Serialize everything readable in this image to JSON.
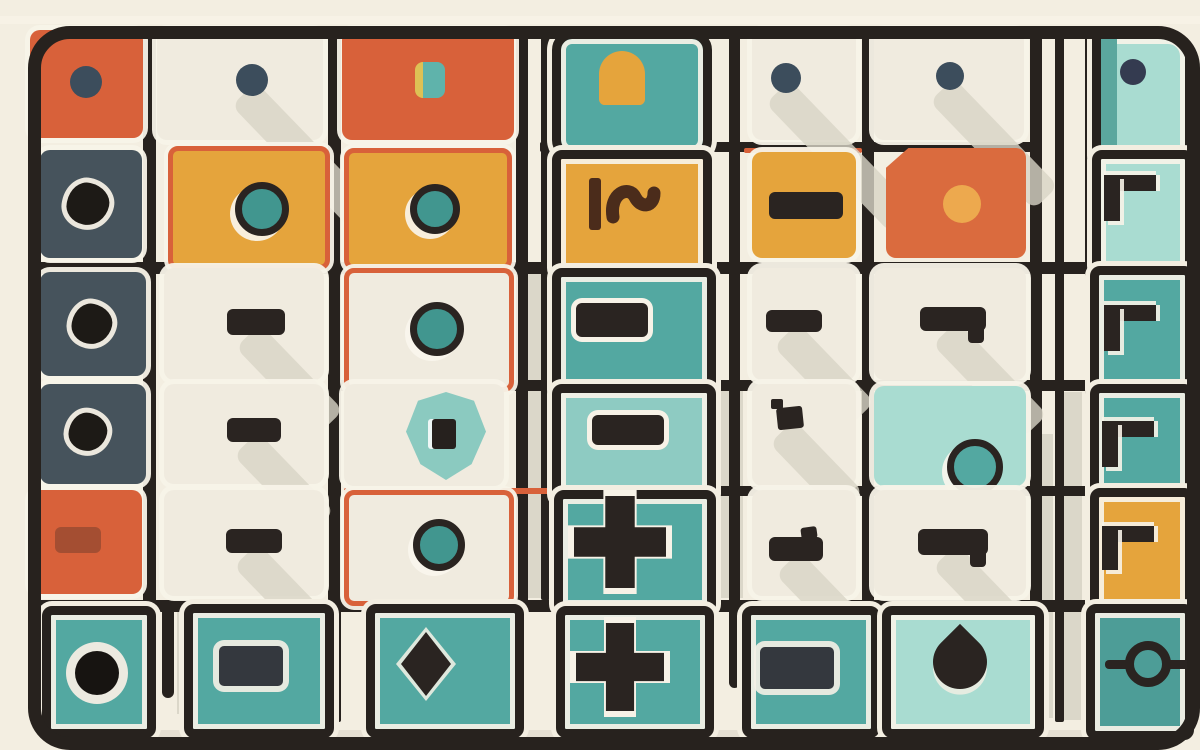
{
  "scene": {
    "title": "abstract-tile-grid-illustration",
    "palette": {
      "bg": "#f3eee1",
      "line": "#27221e",
      "cream": "#f0ebdf",
      "cream_bright": "#f7f2e7",
      "orange": "#d8613a",
      "orange_deep": "#da6b3e",
      "amber": "#e5a43c",
      "teal": "#53a8a1",
      "teal_deep": "#4d9d97",
      "teal_mid": "#8ecbc2",
      "teal_light": "#a9dcd1",
      "slate": "#46535c",
      "dark": "#2a2421",
      "navy": "#3c4d5c",
      "navy_deep": "#343b50",
      "gray": "#d8d4c6",
      "ring_teal": "#41968f",
      "amber_dot": "#eda94e",
      "brown": "#4b2c1b",
      "yellow_sliver": "#ddc155"
    },
    "decor": [
      {
        "x": 520,
        "y": 270,
        "w": 30,
        "h": 328,
        "color": "gray",
        "opacity": 0.9
      },
      {
        "x": 703,
        "y": 388,
        "w": 40,
        "h": 210,
        "color": "gray",
        "opacity": 0.9
      },
      {
        "x": 745,
        "y": 606,
        "w": 38,
        "h": 112,
        "color": "gray",
        "opacity": 0.9
      },
      {
        "x": 1060,
        "y": 392,
        "w": 22,
        "h": 328,
        "color": "gray",
        "opacity": 0.9
      },
      {
        "x": 1033,
        "y": 434,
        "w": 20,
        "h": 284,
        "color": "gray",
        "opacity": 0.9
      },
      {
        "x": 177,
        "y": 602,
        "w": 18,
        "h": 112,
        "color": "gray",
        "opacity": 0.9
      },
      {
        "x": 90,
        "y": 730,
        "w": 1020,
        "h": 12,
        "color": "gray",
        "opacity": 0.55,
        "round": true
      },
      {
        "x": 0,
        "y": 16,
        "w": 1200,
        "h": 8,
        "color": "cream_bright",
        "opacity": 0.9
      }
    ],
    "lines": [
      {
        "x": 143,
        "y": 30,
        "w": 13,
        "h": 692
      },
      {
        "x": 328,
        "y": 30,
        "w": 13,
        "h": 692
      },
      {
        "x": 516,
        "y": 30,
        "w": 12,
        "h": 692
      },
      {
        "x": 541,
        "y": 30,
        "w": 9,
        "h": 570
      },
      {
        "x": 700,
        "y": 30,
        "w": 13,
        "h": 692
      },
      {
        "x": 729,
        "y": 30,
        "w": 11,
        "h": 658,
        "round": true
      },
      {
        "x": 862,
        "y": 30,
        "w": 12,
        "h": 692
      },
      {
        "x": 1030,
        "y": 30,
        "w": 12,
        "h": 692
      },
      {
        "x": 1055,
        "y": 30,
        "w": 9,
        "h": 692
      },
      {
        "x": 1085,
        "y": 30,
        "w": 11,
        "h": 692
      },
      {
        "x": 162,
        "y": 600,
        "w": 12,
        "h": 98,
        "round": true
      },
      {
        "x": 540,
        "y": 142,
        "w": 494,
        "h": 10
      },
      {
        "x": 744,
        "y": 148,
        "w": 118,
        "h": 5,
        "color": "orange"
      },
      {
        "x": 30,
        "y": 262,
        "w": 1142,
        "h": 12
      },
      {
        "x": 330,
        "y": 380,
        "w": 842,
        "h": 11
      },
      {
        "x": 700,
        "y": 486,
        "w": 472,
        "h": 10
      },
      {
        "x": 344,
        "y": 488,
        "w": 356,
        "h": 6,
        "color": "orange"
      },
      {
        "x": 30,
        "y": 600,
        "w": 1142,
        "h": 12
      }
    ],
    "tiles": [
      {
        "x": 30,
        "y": 30,
        "w": 113,
        "h": 108,
        "fill": "orange",
        "glyph": {
          "type": "dot",
          "cx": 86,
          "cy": 82,
          "r": 16,
          "color": "navy"
        }
      },
      {
        "x": 157,
        "y": 30,
        "w": 166,
        "h": 110,
        "fill": "cream",
        "glyph": {
          "type": "dot",
          "cx": 252,
          "cy": 80,
          "r": 16,
          "color": "navy",
          "diag": 230
        }
      },
      {
        "x": 342,
        "y": 30,
        "w": 172,
        "h": 110,
        "fill": "orange",
        "glyph": {
          "type": "smallsq",
          "cx": 430,
          "cy": 80,
          "w": 30,
          "h": 36
        }
      },
      {
        "x": 552,
        "y": 30,
        "w": 142,
        "h": 112,
        "fill": "teal",
        "frame": true,
        "radius": 20,
        "glyph": {
          "type": "arch",
          "cx": 622,
          "cy": 78,
          "w": 46,
          "h": 54
        }
      },
      {
        "x": 752,
        "y": 30,
        "w": 104,
        "h": 110,
        "fill": "cream",
        "glyph": {
          "type": "dot",
          "cx": 786,
          "cy": 78,
          "r": 15,
          "color": "navy",
          "diag": 180
        }
      },
      {
        "x": 874,
        "y": 30,
        "w": 150,
        "h": 110,
        "fill": "cream",
        "glyph": {
          "type": "dot",
          "cx": 950,
          "cy": 76,
          "r": 14,
          "color": "navy",
          "diag": 150
        }
      },
      {
        "x": 1092,
        "y": 30,
        "w": 84,
        "h": 112,
        "fill": "teal_light",
        "frame": true,
        "radius": "4px 26px 4px 4px",
        "stripe": true,
        "glyph": {
          "type": "dot",
          "cx": 1133,
          "cy": 72,
          "r": 13,
          "color": "navy_deep"
        }
      },
      {
        "x": 40,
        "y": 150,
        "w": 102,
        "h": 108,
        "fill": "slate",
        "glyph": {
          "type": "splat",
          "cx": 88,
          "cy": 204,
          "r": 21
        }
      },
      {
        "x": 168,
        "y": 146,
        "w": 152,
        "h": 114,
        "fill": "amber",
        "orangeBorder": true,
        "glyph": {
          "type": "ring",
          "cx": 255,
          "cy": 202,
          "r": 20
        }
      },
      {
        "x": 344,
        "y": 148,
        "w": 158,
        "h": 112,
        "fill": "amber",
        "orangeBorder": true,
        "glyph": {
          "type": "ring",
          "cx": 428,
          "cy": 202,
          "r": 18
        }
      },
      {
        "x": 552,
        "y": 150,
        "w": 142,
        "h": 110,
        "fill": "amber",
        "frame": true,
        "glyph": {
          "type": "squiggle",
          "cx": 622,
          "cy": 204,
          "w": 78,
          "h": 58
        }
      },
      {
        "x": 752,
        "y": 152,
        "w": 104,
        "h": 106,
        "fill": "amber",
        "glyph": {
          "type": "dash",
          "cx": 806,
          "cy": 205,
          "w": 74,
          "h": 27
        }
      },
      {
        "x": 886,
        "y": 148,
        "w": 140,
        "h": 110,
        "fill": "orange_deep",
        "clip": "polygon(16% 0,100% 0,100% 100%,0 100%,0 18%)",
        "glyph": {
          "type": "dot",
          "cx": 962,
          "cy": 204,
          "r": 19,
          "color": "amber_dot"
        }
      },
      {
        "x": 1092,
        "y": 150,
        "w": 84,
        "h": 108,
        "fill": "teal_light",
        "frame": true,
        "glyph": {
          "type": "bracket",
          "cx": 1130,
          "cy": 198,
          "w": 52,
          "h": 46
        }
      },
      {
        "x": 40,
        "y": 272,
        "w": 106,
        "h": 104,
        "fill": "slate",
        "glyph": {
          "type": "splat",
          "cx": 92,
          "cy": 324,
          "r": 20
        }
      },
      {
        "x": 164,
        "y": 268,
        "w": 160,
        "h": 112,
        "fill": "cream",
        "glyph": {
          "type": "dash",
          "cx": 256,
          "cy": 322,
          "w": 58,
          "h": 26,
          "diag": 120
        }
      },
      {
        "x": 344,
        "y": 268,
        "w": 160,
        "h": 114,
        "fill": "cream",
        "orangeBorder": true,
        "glyph": {
          "type": "ring",
          "cx": 430,
          "cy": 322,
          "r": 20
        }
      },
      {
        "x": 552,
        "y": 268,
        "w": 146,
        "h": 114,
        "fill": "teal",
        "frame": true,
        "glyph": {
          "type": "dash",
          "cx": 612,
          "cy": 320,
          "w": 72,
          "h": 34,
          "outline": true
        }
      },
      {
        "x": 752,
        "y": 268,
        "w": 104,
        "h": 112,
        "fill": "cream",
        "glyph": {
          "type": "dash",
          "cx": 794,
          "cy": 321,
          "w": 56,
          "h": 22,
          "diag": 110
        }
      },
      {
        "x": 874,
        "y": 268,
        "w": 152,
        "h": 112,
        "fill": "cream",
        "glyph": {
          "type": "dash",
          "cx": 953,
          "cy": 319,
          "w": 66,
          "h": 24,
          "tabBottom": true,
          "diag": 130
        }
      },
      {
        "x": 1090,
        "y": 266,
        "w": 86,
        "h": 116,
        "fill": "teal",
        "frame": true,
        "glyph": {
          "type": "bracket",
          "cx": 1130,
          "cy": 328,
          "w": 52,
          "h": 46
        }
      },
      {
        "x": 40,
        "y": 384,
        "w": 106,
        "h": 100,
        "fill": "slate",
        "glyph": {
          "type": "splat",
          "cx": 88,
          "cy": 432,
          "r": 19
        }
      },
      {
        "x": 164,
        "y": 384,
        "w": 160,
        "h": 100,
        "fill": "cream",
        "glyph": {
          "type": "dash",
          "cx": 254,
          "cy": 430,
          "w": 54,
          "h": 24,
          "diag": 110
        }
      },
      {
        "x": 344,
        "y": 384,
        "w": 160,
        "h": 102,
        "fill": "cream",
        "glyph": {
          "type": "shield",
          "cx": 446,
          "cy": 436,
          "w": 80,
          "h": 88
        }
      },
      {
        "x": 552,
        "y": 384,
        "w": 146,
        "h": 102,
        "fill": "teal_mid",
        "frame": true,
        "glyph": {
          "type": "dash",
          "cx": 628,
          "cy": 430,
          "w": 72,
          "h": 30,
          "outline": true
        }
      },
      {
        "x": 752,
        "y": 384,
        "w": 104,
        "h": 102,
        "fill": "cream",
        "glyph": {
          "type": "flag",
          "cx": 790,
          "cy": 418,
          "w": 26,
          "h": 22,
          "diag": 100
        }
      },
      {
        "x": 874,
        "y": 386,
        "w": 152,
        "h": 100,
        "fill": "teal_light",
        "glyph": {
          "type": "ring",
          "cx": 968,
          "cy": 460,
          "r": 21,
          "fill": "teal"
        }
      },
      {
        "x": 1090,
        "y": 384,
        "w": 86,
        "h": 104,
        "fill": "teal",
        "frame": true,
        "glyph": {
          "type": "bracket",
          "cx": 1128,
          "cy": 444,
          "w": 52,
          "h": 46
        }
      },
      {
        "x": 30,
        "y": 490,
        "w": 112,
        "h": 104,
        "fill": "orange",
        "glyph": {
          "type": "dash",
          "cx": 78,
          "cy": 540,
          "w": 46,
          "h": 26,
          "opacity": 0.3
        }
      },
      {
        "x": 164,
        "y": 490,
        "w": 160,
        "h": 106,
        "fill": "cream",
        "glyph": {
          "type": "dash",
          "cx": 254,
          "cy": 541,
          "w": 56,
          "h": 24,
          "diag": 110
        }
      },
      {
        "x": 344,
        "y": 490,
        "w": 160,
        "h": 106,
        "fill": "cream",
        "orangeBorder": true,
        "glyph": {
          "type": "ring",
          "cx": 432,
          "cy": 538,
          "r": 19
        }
      },
      {
        "x": 554,
        "y": 490,
        "w": 144,
        "h": 106,
        "fill": "teal",
        "frame": true,
        "glyph": {
          "type": "plus",
          "cx": 620,
          "cy": 542,
          "s": 92
        }
      },
      {
        "x": 752,
        "y": 490,
        "w": 104,
        "h": 106,
        "fill": "cream",
        "glyph": {
          "type": "dash",
          "cx": 796,
          "cy": 549,
          "w": 54,
          "h": 24,
          "tab": true,
          "diag": 110
        }
      },
      {
        "x": 874,
        "y": 490,
        "w": 152,
        "h": 106,
        "fill": "cream",
        "glyph": {
          "type": "dash",
          "cx": 953,
          "cy": 542,
          "w": 70,
          "h": 26,
          "tabBottom": true,
          "diag": 120
        }
      },
      {
        "x": 1090,
        "y": 488,
        "w": 86,
        "h": 108,
        "fill": "amber",
        "frame": true,
        "glyph": {
          "type": "bracket",
          "cx": 1128,
          "cy": 548,
          "w": 52,
          "h": 44
        }
      },
      {
        "x": 42,
        "y": 606,
        "w": 96,
        "h": 114,
        "fill": "teal",
        "frame": true,
        "glyph": {
          "type": "dotring",
          "cx": 88,
          "cy": 664,
          "r": 14
        }
      },
      {
        "x": 184,
        "y": 604,
        "w": 132,
        "h": 116,
        "fill": "teal",
        "frame": true,
        "glyph": {
          "type": "rect",
          "cx": 251,
          "cy": 666,
          "w": 64,
          "h": 40
        }
      },
      {
        "x": 366,
        "y": 604,
        "w": 140,
        "h": 116,
        "fill": "teal",
        "frame": true,
        "glyph": {
          "type": "diamond",
          "cx": 426,
          "cy": 664,
          "w": 50,
          "h": 64
        }
      },
      {
        "x": 556,
        "y": 606,
        "w": 140,
        "h": 114,
        "fill": "teal",
        "frame": true,
        "glyph": {
          "type": "plus",
          "cx": 620,
          "cy": 667,
          "s": 88
        }
      },
      {
        "x": 742,
        "y": 606,
        "w": 120,
        "h": 114,
        "fill": "teal",
        "frame": true,
        "glyph": {
          "type": "rect",
          "cx": 797,
          "cy": 668,
          "w": 74,
          "h": 42
        }
      },
      {
        "x": 882,
        "y": 606,
        "w": 144,
        "h": 114,
        "fill": "teal_light",
        "frame": true,
        "glyph": {
          "type": "drop",
          "cx": 960,
          "cy": 662,
          "s": 54
        }
      },
      {
        "x": 1086,
        "y": 604,
        "w": 90,
        "h": 118,
        "fill": "teal_deep",
        "frame": true,
        "glyph": {
          "type": "circleline",
          "cx": 1148,
          "cy": 664,
          "r": 16,
          "lw": 86
        }
      }
    ]
  }
}
